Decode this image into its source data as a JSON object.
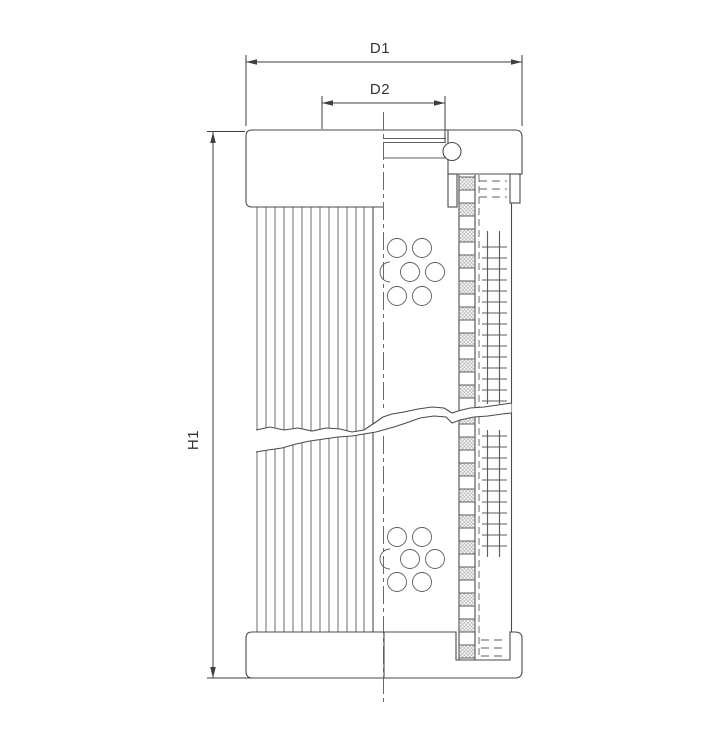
{
  "page": {
    "background": "#ffffff"
  },
  "drawing": {
    "type": "filter-element-cross-section",
    "view": "sectioned technical drawing of a hydraulic filter cartridge",
    "labels": {
      "d1": "D1",
      "d2": "D2",
      "h1": "H1"
    }
  },
  "colors": {
    "background": "#ffffff",
    "object_line": "#4a4a4a",
    "dimension_line": "#3f3f3f",
    "label_text": "#333333",
    "hatch_line": "#8c8c8c"
  }
}
